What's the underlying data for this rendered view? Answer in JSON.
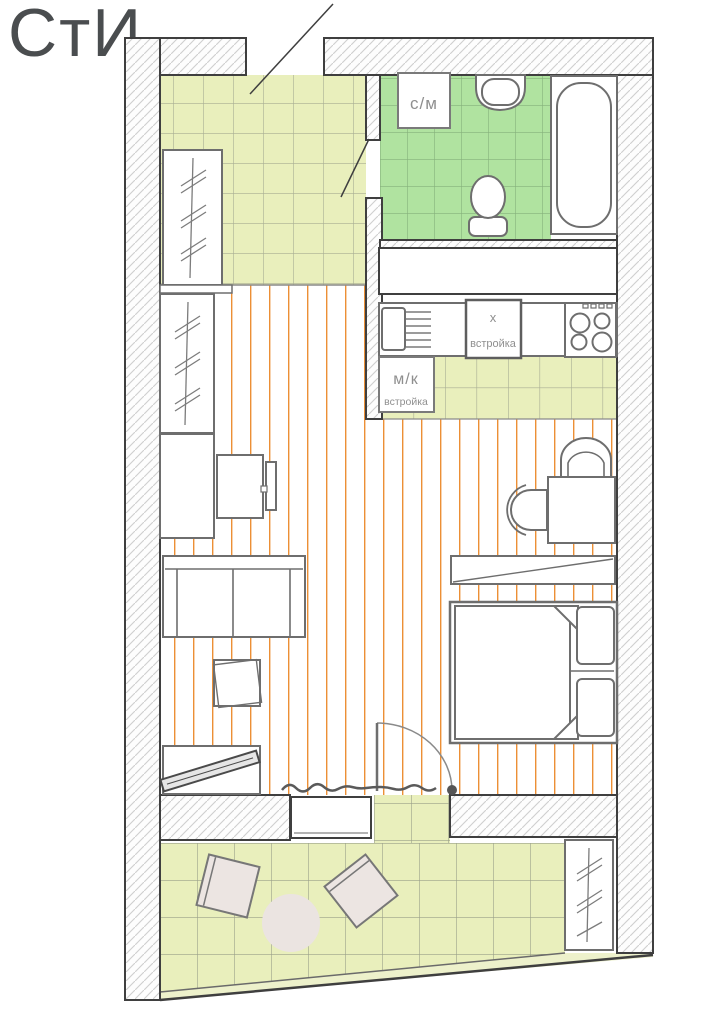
{
  "title": "СтИ",
  "bathroom": {
    "washer_label": "с/м"
  },
  "kitchen": {
    "fridge_label": "х",
    "fridge_sublabel": "встройка",
    "builtin_label": "м/к",
    "builtin_sublabel": "встройка"
  },
  "colors": {
    "hall_balcony_tile": "#e9efbc",
    "bathroom_tile": "#b0e3a0",
    "plank_stripe": "#ec8f35",
    "wall_outline": "#3f3f3f",
    "furniture_outline": "#6e6e6e",
    "balcony_furniture_fill": "#ece5e2",
    "label_text": "#8f8f8f",
    "logo_text": "#4a4d4f"
  }
}
